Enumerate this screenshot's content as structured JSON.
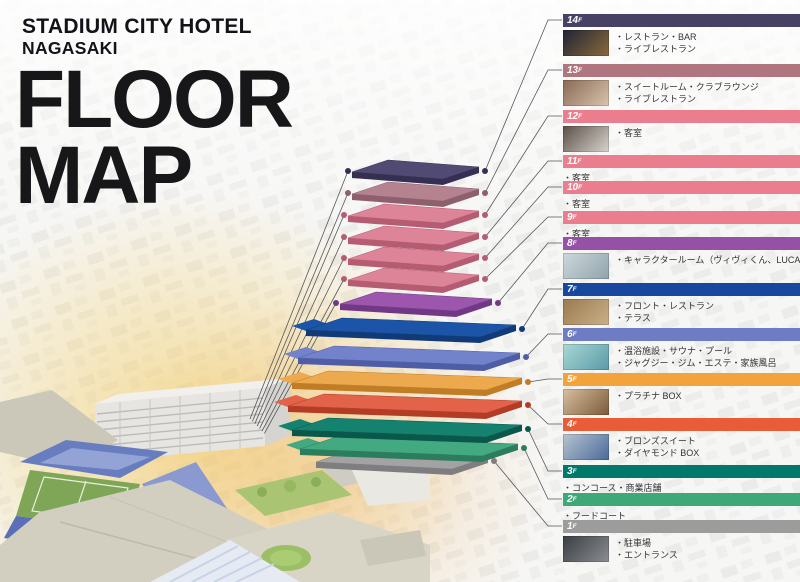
{
  "header": {
    "hotel_name_line1": "STADIUM CITY HOTEL",
    "hotel_name_line2": "NAGASAKI",
    "title_line1": "FLOOR",
    "title_line2": "MAP"
  },
  "legend": {
    "floors": [
      {
        "num": "14",
        "suffix": "F",
        "color": "#474264",
        "edge": "#353052",
        "plate": "#514b73",
        "items": [
          "・レストラン・BAR",
          "・ライブレストラン"
        ],
        "photo": "restaurant-bar-photo",
        "photo_colors": [
          "#1f2436",
          "#8a6a3a"
        ]
      },
      {
        "num": "13",
        "suffix": "F",
        "color": "#b0767f",
        "edge": "#8e5f6d",
        "plate": "#b4838f",
        "items": [
          "・スイートルーム・クラブラウンジ",
          "・ライブレストラン"
        ],
        "photo": "suite-room-photo",
        "photo_colors": [
          "#8a6a55",
          "#d8c4ae"
        ]
      },
      {
        "num": "12",
        "suffix": "F",
        "color": "#ea7e8f",
        "edge": "#b65c72",
        "plate": "#dd8499",
        "items": [
          "・客室"
        ],
        "photo": "guest-room-photo",
        "photo_colors": [
          "#5a5048",
          "#d8d4ce"
        ]
      },
      {
        "num": "11",
        "suffix": "F",
        "color": "#ea7e8f",
        "edge": "#b65c72",
        "plate": "#dd8499",
        "items": [
          "・客室"
        ],
        "photo": null,
        "photo_colors": null
      },
      {
        "num": "10",
        "suffix": "F",
        "color": "#ea7e8f",
        "edge": "#b65c72",
        "plate": "#dd8499",
        "items": [
          "・客室"
        ],
        "photo": null,
        "photo_colors": null
      },
      {
        "num": "9",
        "suffix": "F",
        "color": "#ea7e8f",
        "edge": "#b65c72",
        "plate": "#dd8499",
        "items": [
          "・客室"
        ],
        "photo": null,
        "photo_colors": null
      },
      {
        "num": "8",
        "suffix": "F",
        "color": "#9551a5",
        "edge": "#713886",
        "plate": "#9c56ad",
        "items": [
          "・キャラクタールーム（ヴィヴィくん、LUCA）"
        ],
        "photo": "character-room-photo",
        "photo_colors": [
          "#cfd8da",
          "#8fa3ad"
        ]
      },
      {
        "num": "7",
        "suffix": "F",
        "color": "#17479e",
        "edge": "#113a78",
        "plate": "#1c55a8",
        "items": [
          "・フロント・レストラン",
          "・テラス"
        ],
        "photo": "front-restaurant-photo",
        "photo_colors": [
          "#9a7a4e",
          "#c9b089"
        ]
      },
      {
        "num": "6",
        "suffix": "F",
        "color": "#6e7cc3",
        "edge": "#4f5da6",
        "plate": "#7383cb",
        "items": [
          "・温浴施設・サウナ・プール",
          "・ジャグジー・ジム・エステ・家族風呂"
        ],
        "photo": "spa-pool-photo",
        "photo_colors": [
          "#a8d8d4",
          "#5a9aa8"
        ]
      },
      {
        "num": "5",
        "suffix": "F",
        "color": "#f2a33c",
        "edge": "#c07d26",
        "plate": "#eca94e",
        "items": [
          "・プラチナ BOX"
        ],
        "photo": "platinum-box-photo",
        "photo_colors": [
          "#d8c0a0",
          "#7a5a3a"
        ]
      },
      {
        "num": "4",
        "suffix": "F",
        "color": "#e85c38",
        "edge": "#b23c24",
        "plate": "#e2634a",
        "items": [
          "・ブロンズスイート",
          "・ダイヤモンド BOX"
        ],
        "photo": "bronze-suite-photo",
        "photo_colors": [
          "#b8c4d0",
          "#4a6a9a"
        ]
      },
      {
        "num": "3",
        "suffix": "F",
        "color": "#00796a",
        "edge": "#0a584c",
        "plate": "#15816f",
        "items": [
          "・コンコース・商業店舗"
        ],
        "photo": null,
        "photo_colors": null
      },
      {
        "num": "2",
        "suffix": "F",
        "color": "#3ea878",
        "edge": "#2b7d5e",
        "plate": "#43a981",
        "items": [
          "・フードコート"
        ],
        "photo": null,
        "photo_colors": null
      },
      {
        "num": "1",
        "suffix": "F",
        "color": "#9c9c9c",
        "edge": "#7e7e80",
        "plate": "#a3a3a5",
        "items": [
          "・駐車場",
          "・エントランス"
        ],
        "photo": "entrance-photo",
        "photo_colors": [
          "#3a3d42",
          "#8a8d92"
        ]
      }
    ]
  }
}
